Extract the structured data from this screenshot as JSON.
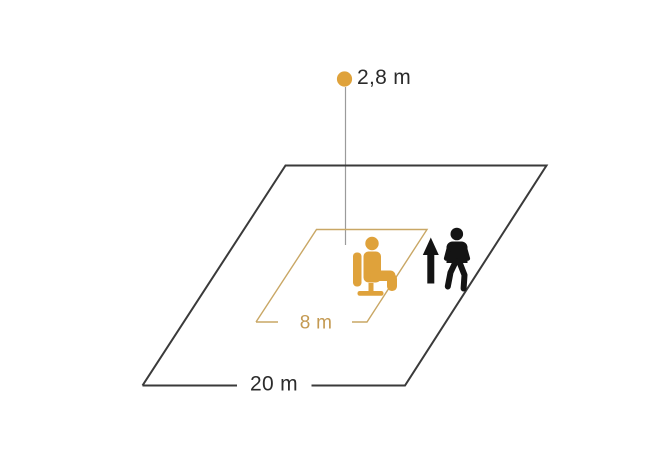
{
  "diagram": {
    "labels": {
      "mounting_height": "2,8 m",
      "inner_zone": "8 m",
      "outer_zone": "20 m"
    },
    "colors": {
      "accent_orange": "#DFA23B",
      "zone_gold": "#C9A765",
      "gold_text": "#C49A52",
      "outline_dark": "#3A3A3A",
      "text_dark": "#2B2B2B",
      "plumb_gray": "#9B9B9B",
      "icon_black": "#141414",
      "background": "#FFFFFF"
    },
    "icons": {
      "sensor_dot": "sensor-dot-icon",
      "seated_person": "seated-person-icon",
      "standing_person": "standing-person-icon",
      "up_arrow": "up-arrow-icon"
    }
  }
}
